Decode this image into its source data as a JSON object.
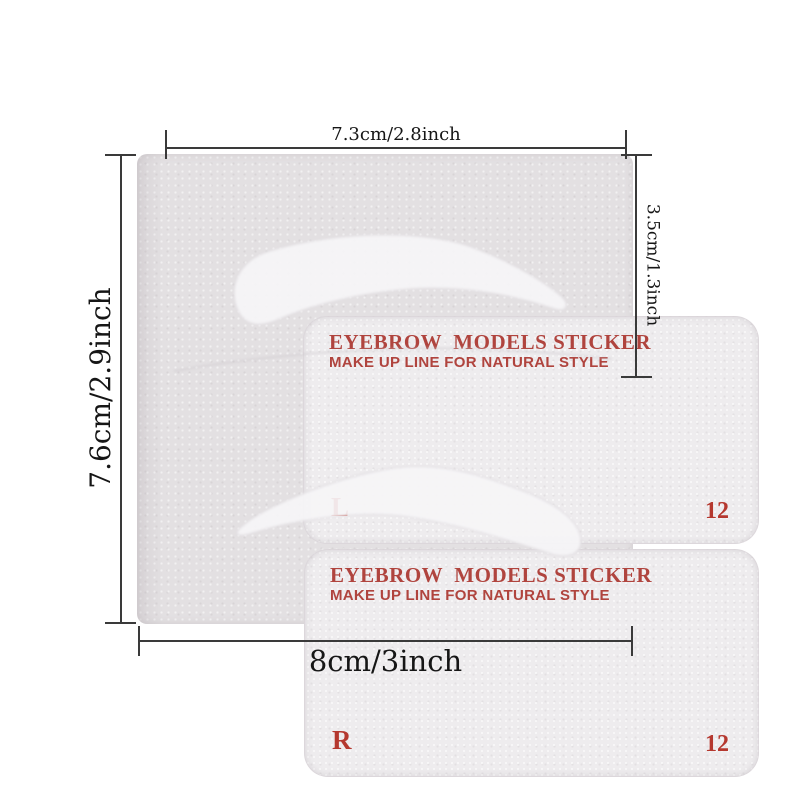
{
  "colors": {
    "page_bg": "#ffffff",
    "sheet": "#e3e0e2",
    "panel": "#eeecee",
    "brow": "#f6f5f7",
    "brow_edge": "#dcd8dc",
    "title_red": "#b0443e",
    "label_red": "#b5382f",
    "dim_line": "#3a3a3a",
    "dim_text": "#161616"
  },
  "product": {
    "stickers": [
      {
        "title": "EYEBROW  MODELS STICKER",
        "subtitle": "MAKE UP LINE FOR NATURAL STYLE",
        "side_label": "L",
        "style_number": "12"
      },
      {
        "title": "EYEBROW  MODELS STICKER",
        "subtitle": "MAKE UP LINE FOR NATURAL STYLE",
        "side_label": "R",
        "style_number": "12"
      }
    ]
  },
  "annotations": {
    "top": "7.3cm/2.8inch",
    "right": "3.5cm/1.3inch",
    "left": "7.6cm/2.9inch",
    "bottom": "8cm/3inch"
  }
}
